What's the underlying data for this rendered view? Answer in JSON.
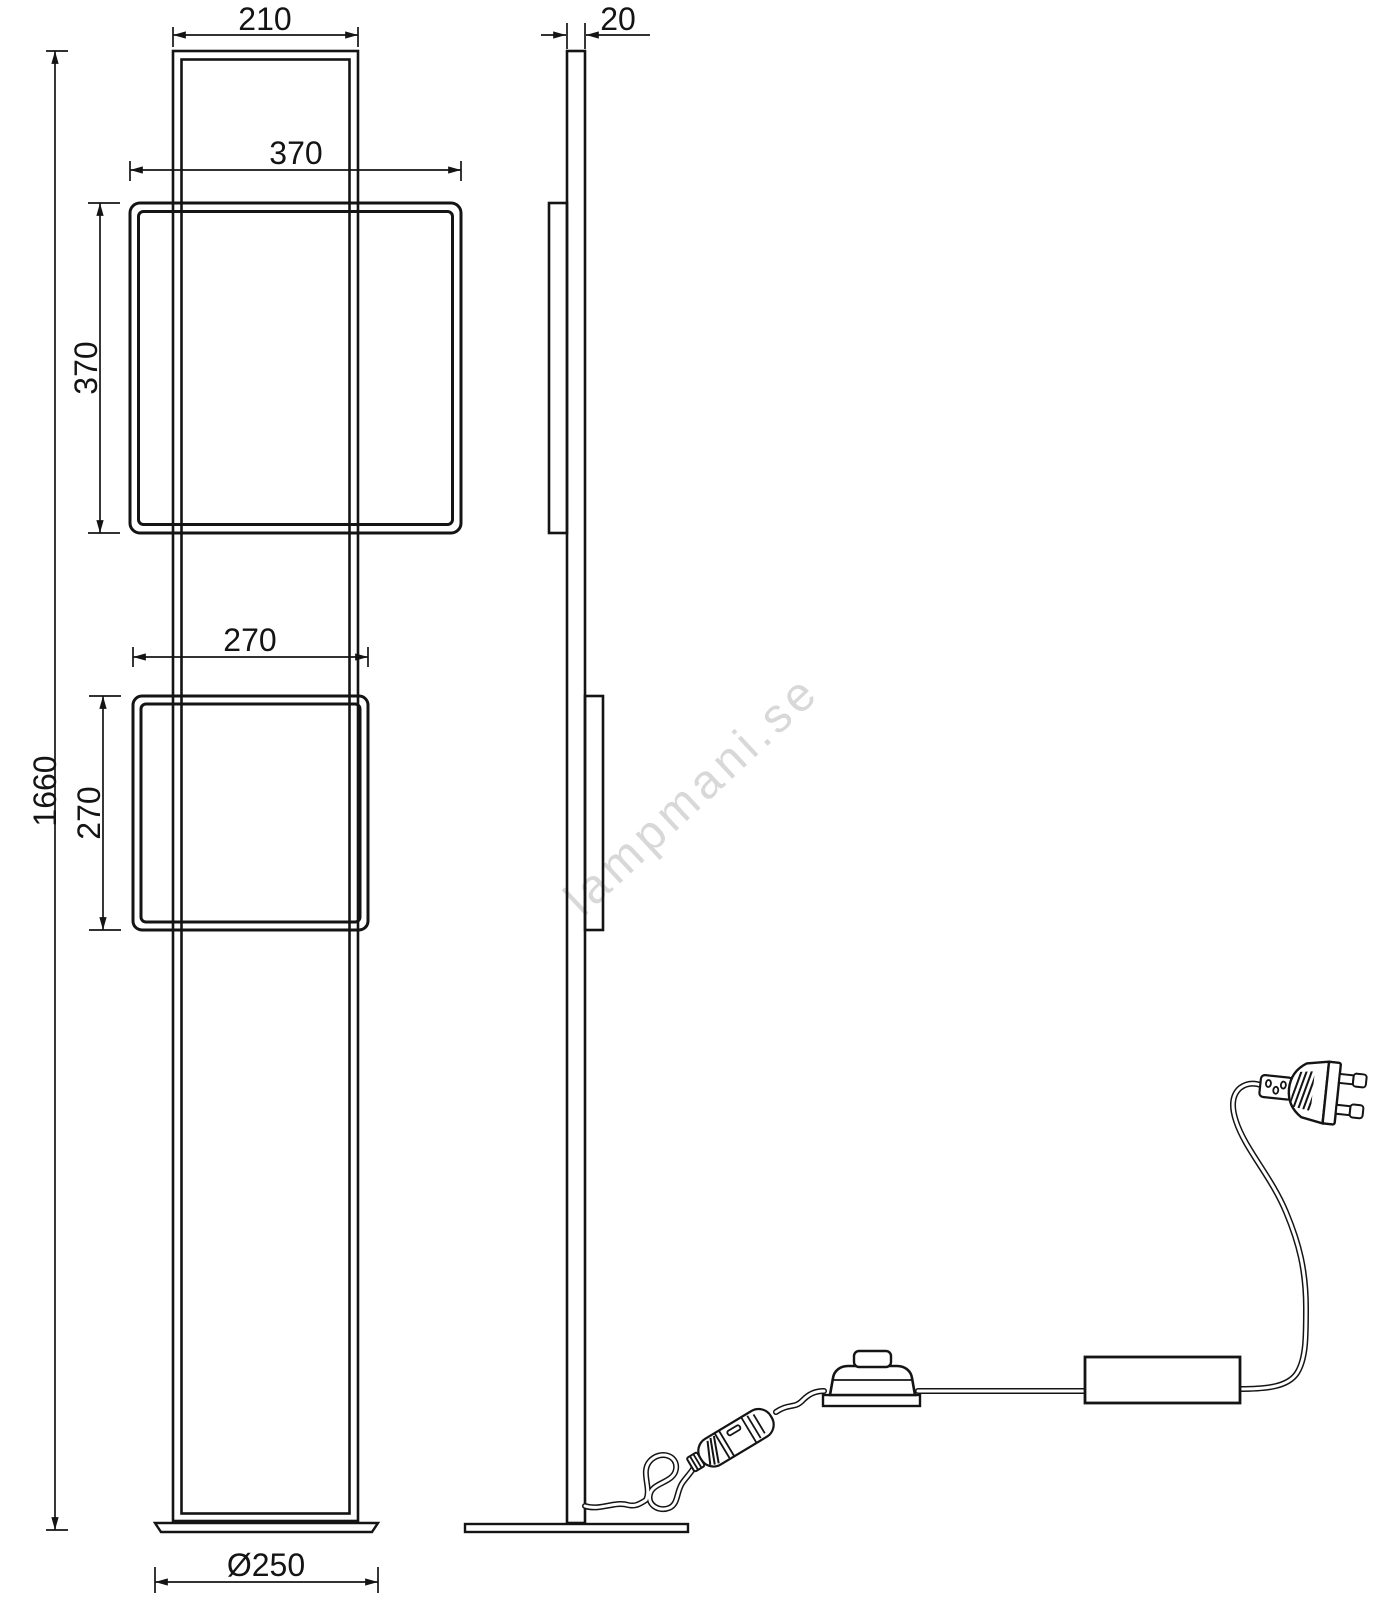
{
  "drawing": {
    "subject": "floor lamp with two square light frames, front and side elevation",
    "line_color": "#141414",
    "background_color": "#ffffff"
  },
  "watermark": {
    "text": "lampmani.se",
    "color": "#d8d8d8"
  },
  "front_view": {
    "dimensions": {
      "top_width_mm": "210",
      "upper_frame_width_mm": "370",
      "upper_frame_height_mm": "370",
      "lower_frame_width_mm": "270",
      "lower_frame_height_mm": "270",
      "total_height_mm": "1660",
      "base_diameter_mm": "Ø250"
    }
  },
  "side_view": {
    "dimensions": {
      "frame_depth_mm": "20"
    }
  }
}
